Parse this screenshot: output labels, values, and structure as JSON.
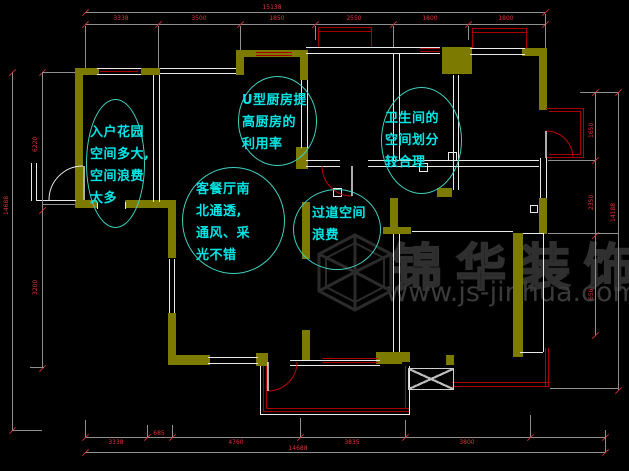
{
  "annotations": [
    {
      "id": "entry-garden",
      "lines": [
        "入户花园",
        "空间多大,",
        "空间浪费",
        "太多"
      ]
    },
    {
      "id": "kitchen",
      "lines": [
        "U型厨房提",
        "高厨房的",
        "利用率"
      ]
    },
    {
      "id": "living-dining",
      "lines": [
        "客餐厅南",
        "北通透,",
        "通风、采",
        "光不错"
      ]
    },
    {
      "id": "bathroom",
      "lines": [
        "卫生间的",
        "空间划分",
        "较合理"
      ]
    },
    {
      "id": "corridor",
      "lines": [
        "过道空间",
        "浪费"
      ]
    }
  ],
  "watermark": {
    "brand": "锦华装饰",
    "website": "www.js-jinhua.com",
    "logo": "wireframe-cube"
  },
  "dimensions": {
    "top": {
      "total": "15138",
      "segments": [
        "3338",
        "3500",
        "1850",
        "2550",
        "1800",
        "1800"
      ]
    },
    "bottom": {
      "total": "14688",
      "segments": [
        "3338",
        "685",
        "4760",
        "3835",
        "3800"
      ]
    },
    "left": {
      "total": "14688",
      "segments": [
        "6220",
        "3200"
      ]
    },
    "right": {
      "total": "14188",
      "segments": [
        "1650",
        "2350",
        "650"
      ]
    }
  },
  "colors": {
    "background": "#000000",
    "wall": "#7d7a00",
    "window_red": "#a80000",
    "dimension_text": "#e03434",
    "annotation_text": "#00e6e6",
    "annotation_ellipse": "#3fd0c0",
    "watermark": "#2f2f2f",
    "line_white": "#e9e9e9"
  }
}
